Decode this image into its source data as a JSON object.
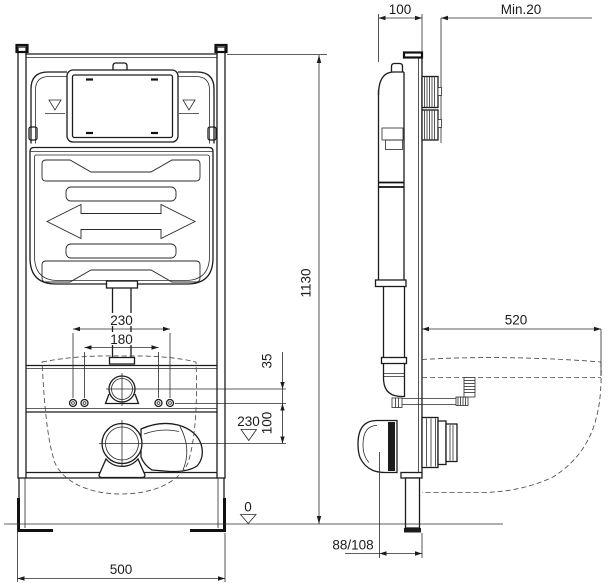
{
  "drawing": {
    "type": "installation dimension drawing",
    "views": {
      "left": "front view of concealed cistern frame",
      "right": "side view with wall-hung bowl outline"
    }
  },
  "dimensions": {
    "front": {
      "frame_width": "500",
      "frame_height": "1130",
      "bolt_spacing_outer": "230",
      "bolt_spacing_inner": "180",
      "supply_offset": "35",
      "supply_to_drain": "100",
      "drain_height_marker": "230",
      "floor_marker": "0"
    },
    "side": {
      "frame_depth": "100",
      "wall_clearance": "Min.20",
      "bowl_depth": "520",
      "outlet_distance": "88/108"
    }
  },
  "colors": {
    "line": "#1c1c1c",
    "dashed": "#4a4a4a",
    "background": "#ffffff"
  }
}
